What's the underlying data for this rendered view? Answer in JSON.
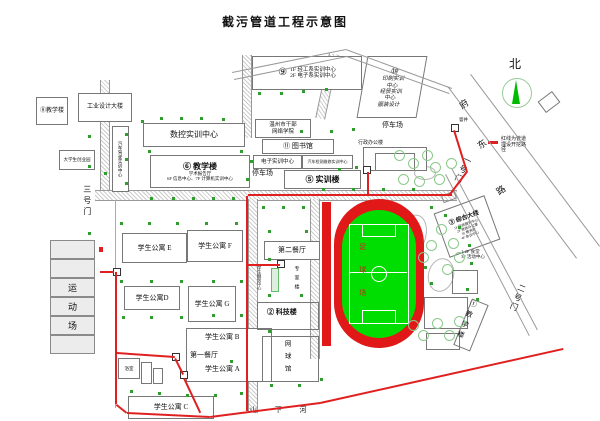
{
  "title": "截污管道工程示意图",
  "compass": {
    "north": "北"
  },
  "legend": {
    "line1": "红线为管道",
    "line2": "埋设开挖路",
    "line3": "径"
  },
  "roads": {
    "fudong_1": "府",
    "fudong_2": "东",
    "fudong_3": "路",
    "gate1": "一号门",
    "gate2": "二号门",
    "gate3": "三号门"
  },
  "river": {
    "name": "山  下  河"
  },
  "manhole": {
    "label": "窨井"
  },
  "stadium": {
    "field": "足球场",
    "stand_rows": [
      "",
      "",
      "运",
      "动",
      "场",
      ""
    ]
  },
  "north_area": {
    "b8": "⑧教学楼",
    "industrial": "工业设计大楼",
    "startup": "大学生创业园",
    "driving": "汽车驾驶实训中心",
    "cnc": "数控实训中心",
    "b6": {
      "title": "⑥ 教学楼",
      "l1": "学术报告厅",
      "l2": "6F 信息中心、7F 计算机实训中心"
    },
    "b9": {
      "num": "⑨",
      "l1": "1F 轻工系实训中心",
      "l2": "2F 电子系实训中心"
    },
    "b10": {
      "num": "⑩",
      "lines": [
        "印刷实训",
        "中心",
        "经贸实训",
        "中心",
        "服装设计"
      ]
    },
    "cadre": {
      "l1": "温州市干部",
      "l2": "网络学院"
    },
    "b11": "⑪ 图书馆",
    "elec": "电子实训中心",
    "auto_repair": "汽车检测维修实训中心",
    "parking_w": "停车场",
    "b5": "⑤ 实训楼",
    "admin": "行政办公楼",
    "parking_e": "停车场"
  },
  "east_area": {
    "b3": {
      "title": "③ 综合大楼",
      "lines": [
        "1F 行政服务中心",
        "2F 党政办公室",
        "3F 教务处",
        "4F 会议中心"
      ]
    },
    "canteen_note": {
      "l1": "1-2F 食堂",
      "l2": "3F 活动中心"
    },
    "b1": "①教学楼"
  },
  "south_area": {
    "apt_e": "学生公寓 E",
    "apt_f": "学生公寓 F",
    "apt_d": "学生公寓D",
    "apt_g": "学生公寓 G",
    "apt_b": "学生公寓 B",
    "apt_a": "学生公寓 A",
    "apt_c": "学生公寓 C",
    "canteen2": "第二餐厅",
    "canteen1": "第一餐厅",
    "service": "学生服务中心",
    "expert": "专家楼",
    "b2": "② 科技楼",
    "tennis": "网球馆",
    "bath": "浴室"
  },
  "colors": {
    "pipeline_red": "#e02020",
    "track_red": "#e01818",
    "field_green": "#00dd00",
    "tree_green": "#2f9e2f"
  }
}
